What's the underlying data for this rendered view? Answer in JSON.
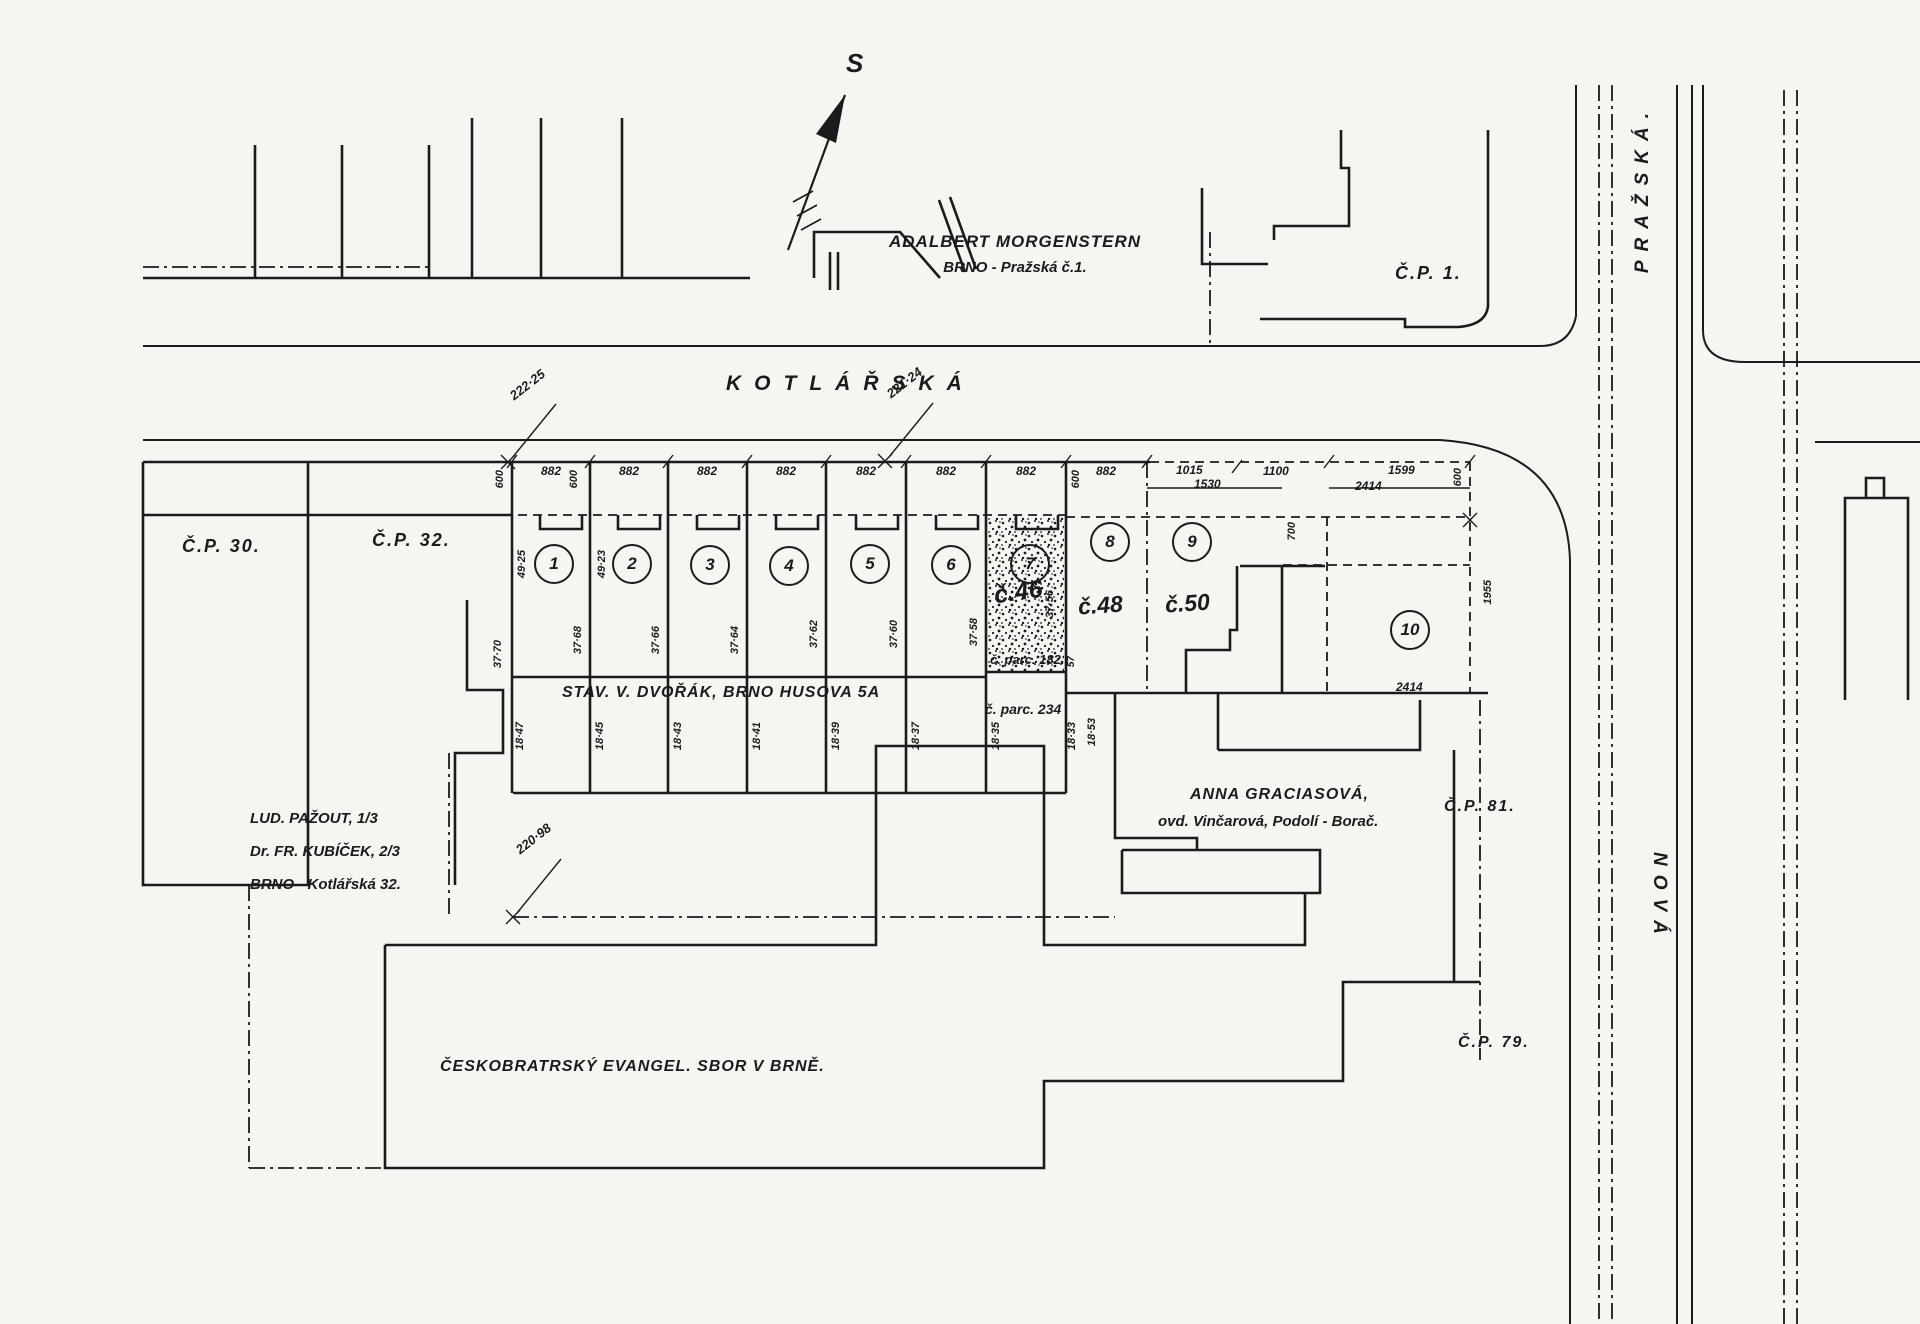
{
  "colors": {
    "paper": "#f6f5f2",
    "ink": "#1b1b1b"
  },
  "compass": {
    "north_label": "S"
  },
  "streets": {
    "kotlarska": "KOTLÁŘSKÁ",
    "prazska": "PRAŽSKÁ.",
    "nova": "NOVÁ"
  },
  "properties": {
    "morgenstern": {
      "line1": "ADALBERT MORGENSTERN",
      "line2": "BRNO - Pražská č.1."
    },
    "cp1": "Č.P. 1.",
    "cp30": "Č.P. 30.",
    "cp32": "Č.P. 32.",
    "cp81": "Č.P. 81.",
    "cp79": "Č.P. 79.",
    "dvorak": "STAV. V. DVOŘÁK, BRNO HUSOVA 5A",
    "pazout": {
      "line1": "LUD. PAŽOUT, 1/3",
      "line2": "Dr. FR. KUBÍČEK, 2/3",
      "line3": "BRNO - Kotlářská 32."
    },
    "graciasova": {
      "line1": "ANNA GRACIASOVÁ,",
      "line2": "ovd. Vinčarová, Podolí - Borač."
    },
    "evangel": "ČESKOBRATRSKÝ EVANGEL. SBOR V BRNĚ."
  },
  "parcels": {
    "parc182": "č. parc. 182.",
    "parc234": "č. parc. 234",
    "house46": "č.46",
    "house48": "č.48",
    "house50": "č.50"
  },
  "plots": {
    "numbers": [
      "1",
      "2",
      "3",
      "4",
      "5",
      "6",
      "7",
      "8",
      "9",
      "10"
    ]
  },
  "dimensions": {
    "benchmark_222_25": "222·25",
    "benchmark_221_24": "221·24",
    "benchmark_220_98": "220·98",
    "width_882": "882",
    "width_1015": "1015",
    "width_1530": "1530",
    "width_1100": "1100",
    "width_2414": "2414",
    "width_1599": "1599",
    "depth_600": "600",
    "depth_700": "700",
    "depth_1955": "1955",
    "offset_57": "57",
    "line_49_25": "49·25",
    "line_49_23": "49·23",
    "line_37_70": "37·70",
    "line_37_68": "37·68",
    "line_37_66": "37·66",
    "line_37_64": "37·64",
    "line_37_62": "37·62",
    "line_37_60": "37·60",
    "line_37_58": "37·58",
    "line_37_56": "37·56",
    "line_18_47": "18·47",
    "line_18_45": "18·45",
    "line_18_43": "18·43",
    "line_18_41": "18·41",
    "line_18_39": "18·39",
    "line_18_37": "18·37",
    "line_18_35": "18·35",
    "line_18_33": "18·33",
    "line_18_53": "18·53"
  }
}
